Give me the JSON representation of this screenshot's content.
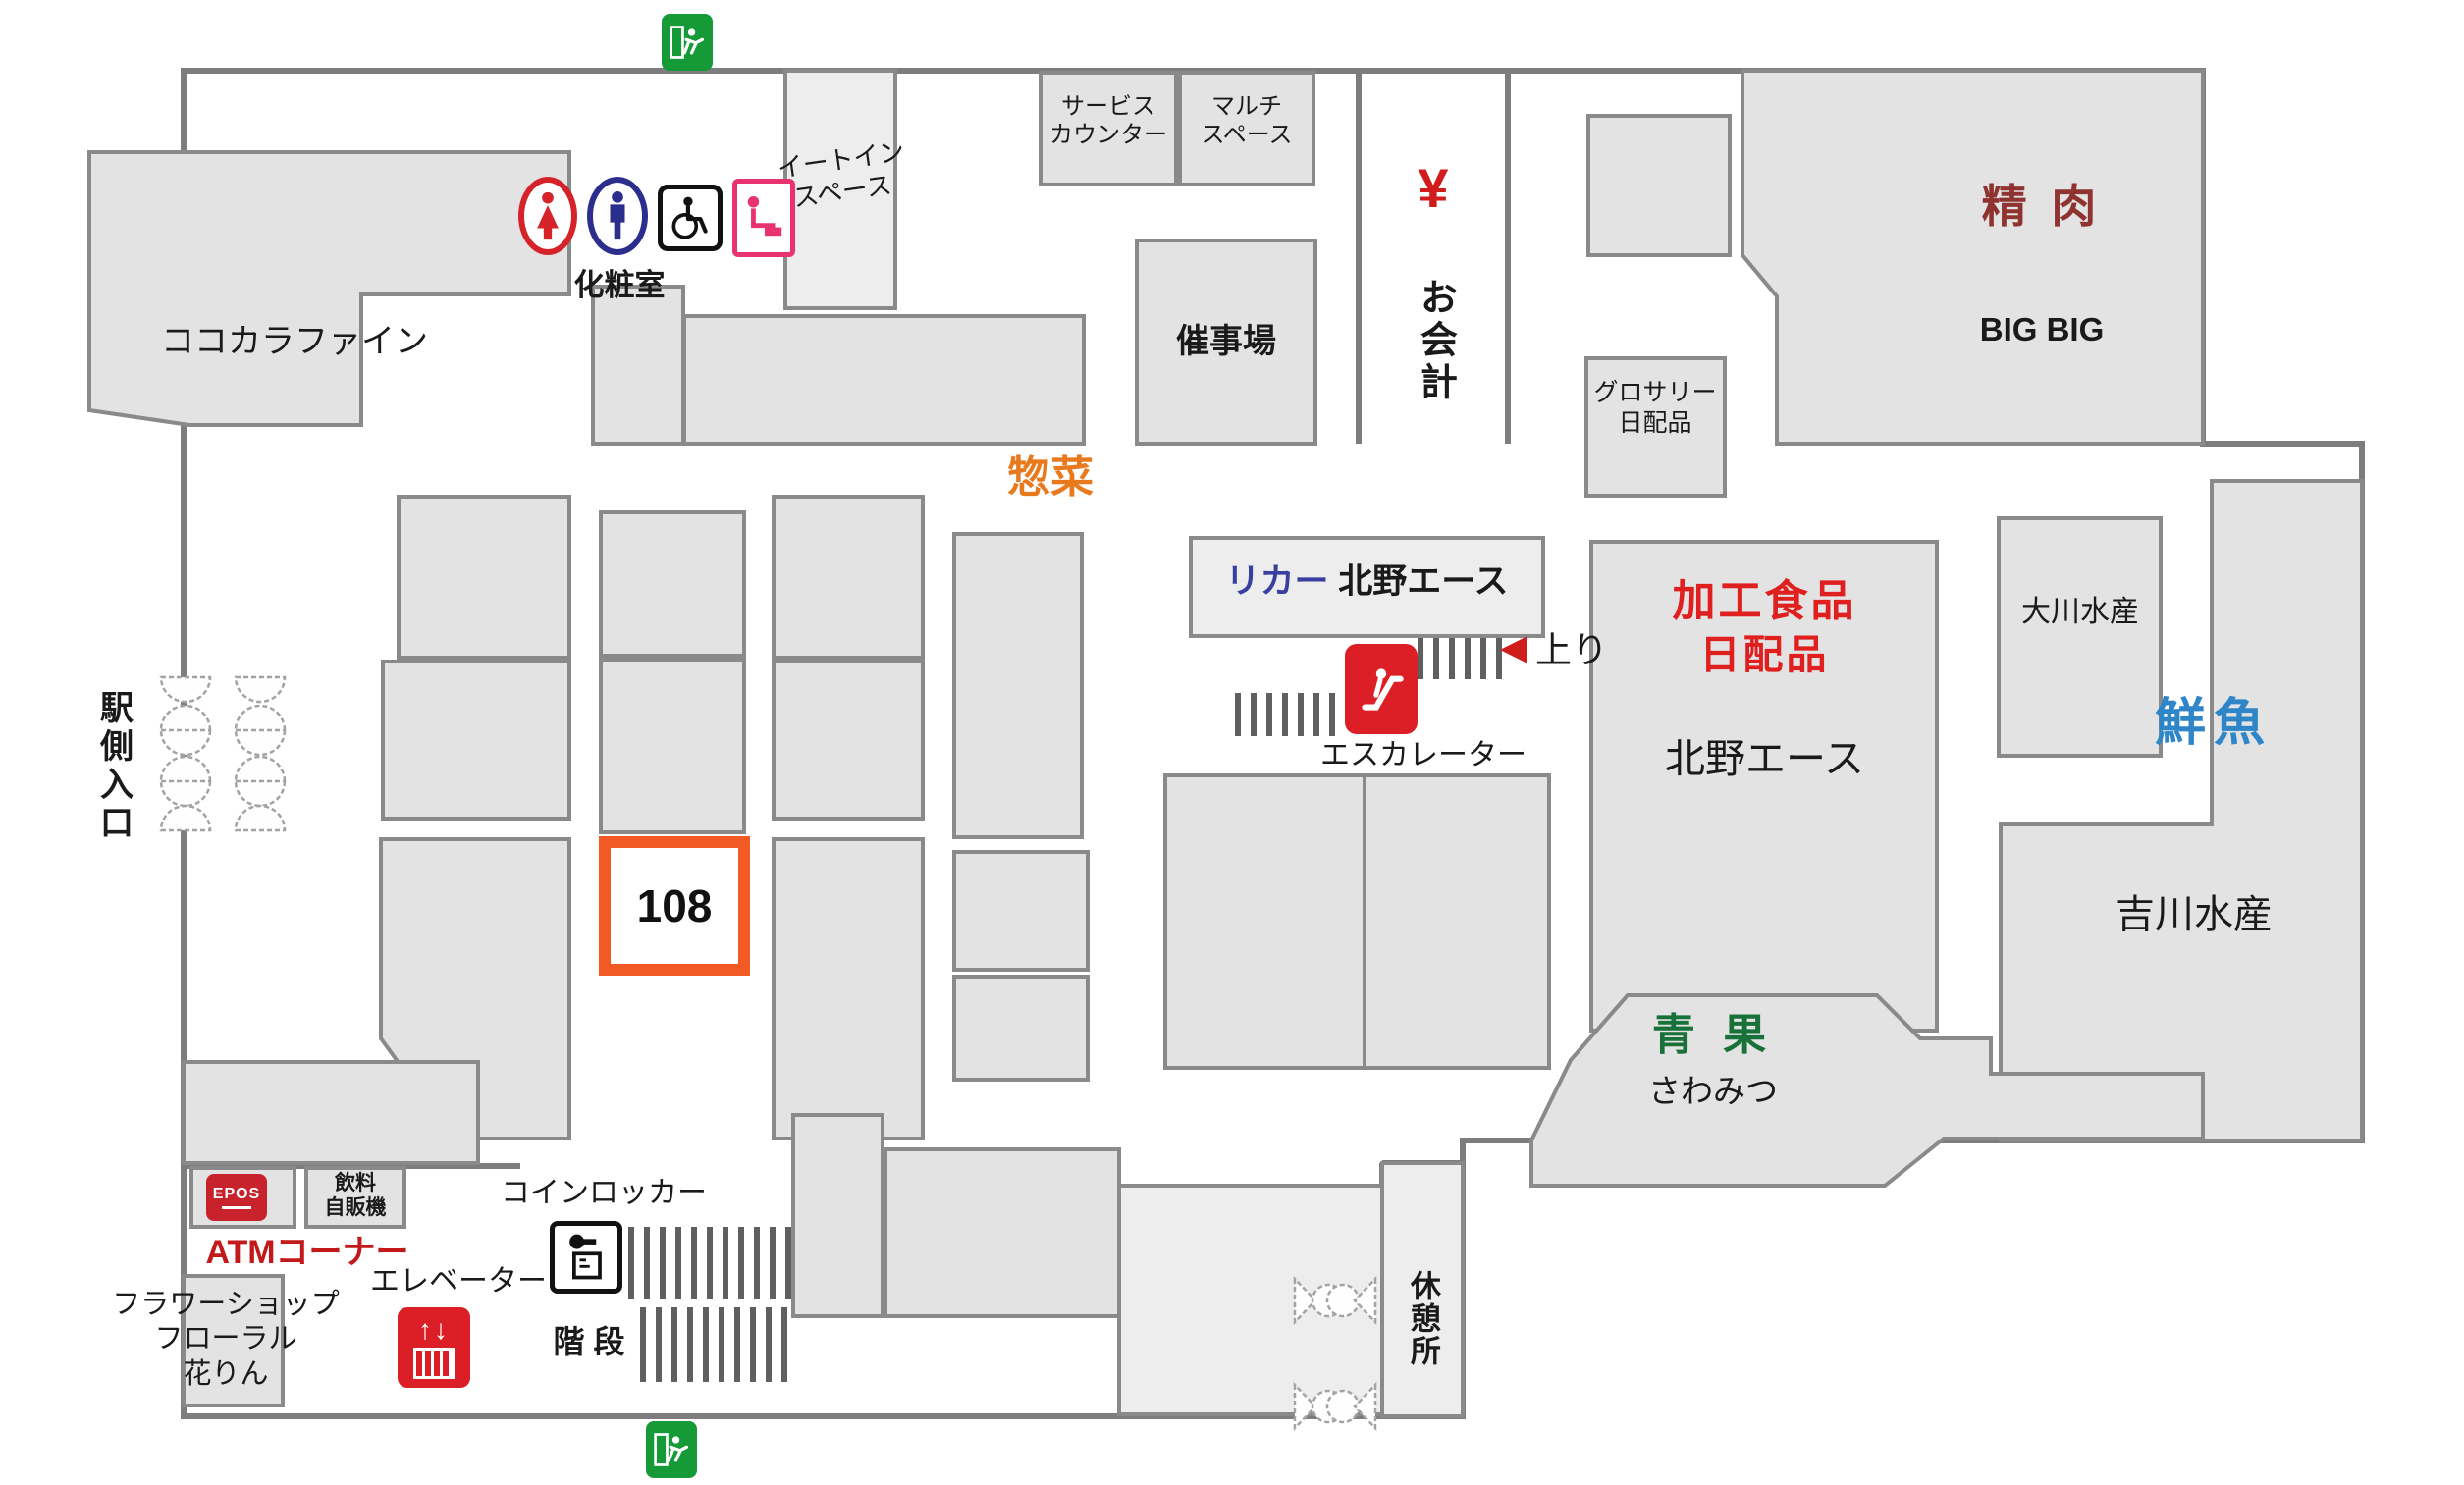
{
  "map_title": "store-floor-map",
  "highlight": {
    "booth_number": "108",
    "border_color": "#f15a24"
  },
  "colors": {
    "block_fill": "#e3e3e3",
    "block_border": "#8a8a8a",
    "wall": "#7d7d7d",
    "meat_red": "#8f3331",
    "deli_orange": "#e8791c",
    "liquor_blue": "#3a3f9f",
    "fish_blue": "#2e86c9",
    "produce_green": "#19713a",
    "food_red": "#e01f1f",
    "atm_red": "#c21a1a",
    "exit_green": "#169a38",
    "icon_red": "#dc1f26",
    "female_red": "#d6232a",
    "male_blue": "#2b2e8c",
    "baby_pink": "#e8336e"
  },
  "areas": {
    "cocokara": {
      "label": "ココカラファイン"
    },
    "restroom": {
      "label": "化粧室"
    },
    "eat_in": {
      "line1": "イートイン",
      "line2": "スペース"
    },
    "service_counter": {
      "line1": "サービス",
      "line2": "カウンター"
    },
    "multi_space": {
      "line1": "マルチ",
      "line2": "スペース"
    },
    "event_space": {
      "label": "催事場"
    },
    "checkout": {
      "yen": "¥",
      "label": "お会計"
    },
    "grocery": {
      "line1": "グロサリー",
      "line2": "日配品"
    },
    "meat": {
      "label": "精 肉",
      "store": "BIG BIG"
    },
    "deli": {
      "label": "惣菜"
    },
    "liquor": {
      "prefix": "リカー",
      "store": "北野エース"
    },
    "escalator": {
      "label": "エスカレーター",
      "direction": "上り"
    },
    "processed_food": {
      "line1": "加工食品",
      "line2": "日配品",
      "store": "北野エース"
    },
    "okawa_suisan": {
      "label": "大川水産"
    },
    "fresh_fish": {
      "label": "鮮魚"
    },
    "yoshikawa_suisan": {
      "label": "吉川水産"
    },
    "station_entrance": {
      "label": "駅側入口"
    },
    "produce": {
      "label": "青 果",
      "store": "さわみつ"
    },
    "rest_area": {
      "label": "休憩所"
    },
    "atm": {
      "label": "ATMコーナー",
      "brand": "EPOS"
    },
    "vending": {
      "line1": "飲料",
      "line2": "自販機"
    },
    "coin_locker": {
      "label": "コインロッカー"
    },
    "elevator": {
      "label": "エレベーター"
    },
    "stairs": {
      "label": "階 段"
    },
    "flower_shop": {
      "line1": "フラワーショップ",
      "line2": "フローラル",
      "line3": "花りん"
    }
  }
}
